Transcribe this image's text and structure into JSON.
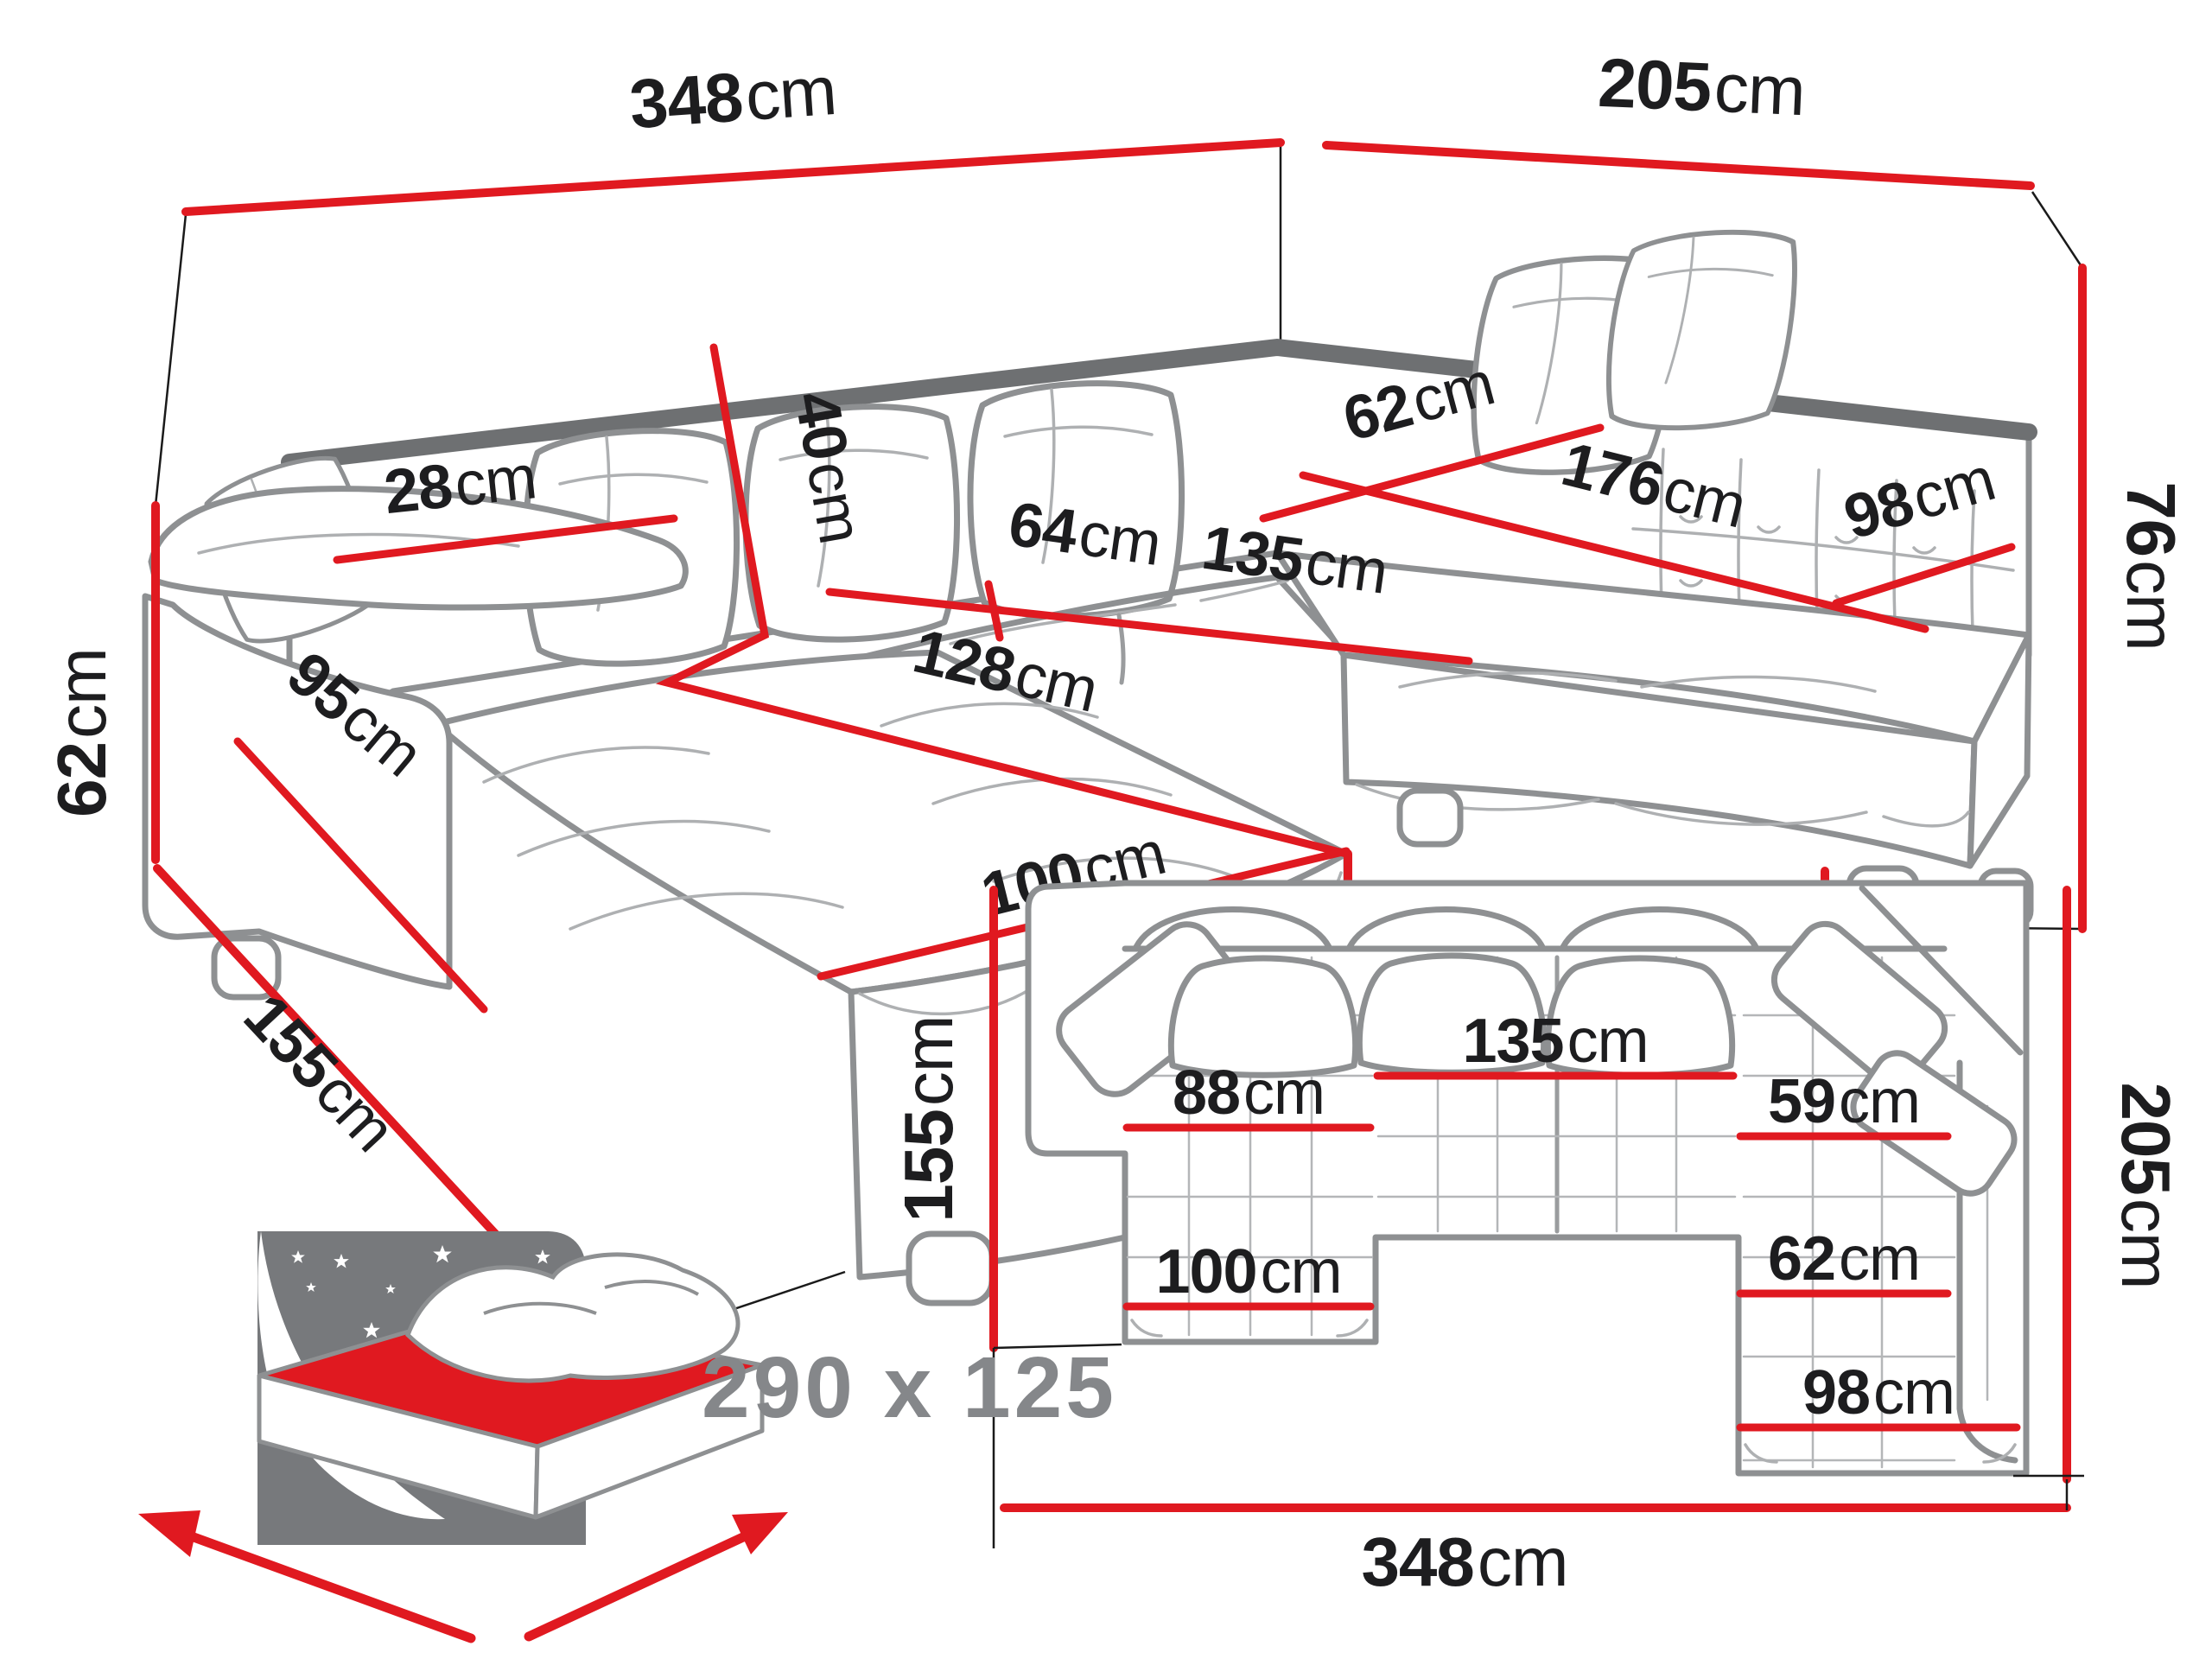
{
  "palette": {
    "dimension_red": "#e01920",
    "label_black": "#1d1d1f",
    "sofa_outline_gray": "#8e9092",
    "sofa_rail_gray": "#6e7072",
    "icon_gray": "#77797c",
    "bed_text_gray": "#85878a",
    "background": "#ffffff"
  },
  "perspective_view": {
    "dims": {
      "total_width": {
        "value": "348",
        "unit": "cm"
      },
      "total_side": {
        "value": "205",
        "unit": "cm"
      },
      "backrest_height": {
        "value": "76",
        "unit": "cm"
      },
      "armrest_height": {
        "value": "62",
        "unit": "cm"
      },
      "armrest_side_length": {
        "value": "95",
        "unit": "cm"
      },
      "chaise_total_depth": {
        "value": "155",
        "unit": "cm"
      },
      "armrest_width": {
        "value": "28",
        "unit": "cm"
      },
      "cushion_height": {
        "value": "40",
        "unit": "cm"
      },
      "chaise_seat_length": {
        "value": "128",
        "unit": "cm"
      },
      "seat_depth_left": {
        "value": "64",
        "unit": "cm"
      },
      "middle_seat_width": {
        "value": "135",
        "unit": "cm"
      },
      "right_seat_depth": {
        "value": "62",
        "unit": "cm"
      },
      "right_seat_length": {
        "value": "176",
        "unit": "cm"
      },
      "right_end_width": {
        "value": "98",
        "unit": "cm"
      },
      "seat_height": {
        "value": "41",
        "unit": "cm"
      },
      "chaise_width": {
        "value": "100",
        "unit": "cm"
      },
      "leg_height": {
        "value": "5",
        "unit": "cm"
      }
    }
  },
  "plan_view": {
    "dims": {
      "total_width": {
        "value": "348",
        "unit": "cm"
      },
      "total_side": {
        "value": "205",
        "unit": "cm"
      },
      "chaise_depth": {
        "value": "155",
        "unit": "cm"
      },
      "middle_seat_width": {
        "value": "135",
        "unit": "cm"
      },
      "chaise_seat_width": {
        "value": "88",
        "unit": "cm"
      },
      "right_seat_width": {
        "value": "59",
        "unit": "cm"
      },
      "right_seat_depth": {
        "value": "62",
        "unit": "cm"
      },
      "chaise_width": {
        "value": "100",
        "unit": "cm"
      },
      "right_end_width": {
        "value": "98",
        "unit": "cm"
      }
    }
  },
  "bed_icon": {
    "sleeping_area": "290 x 125"
  }
}
